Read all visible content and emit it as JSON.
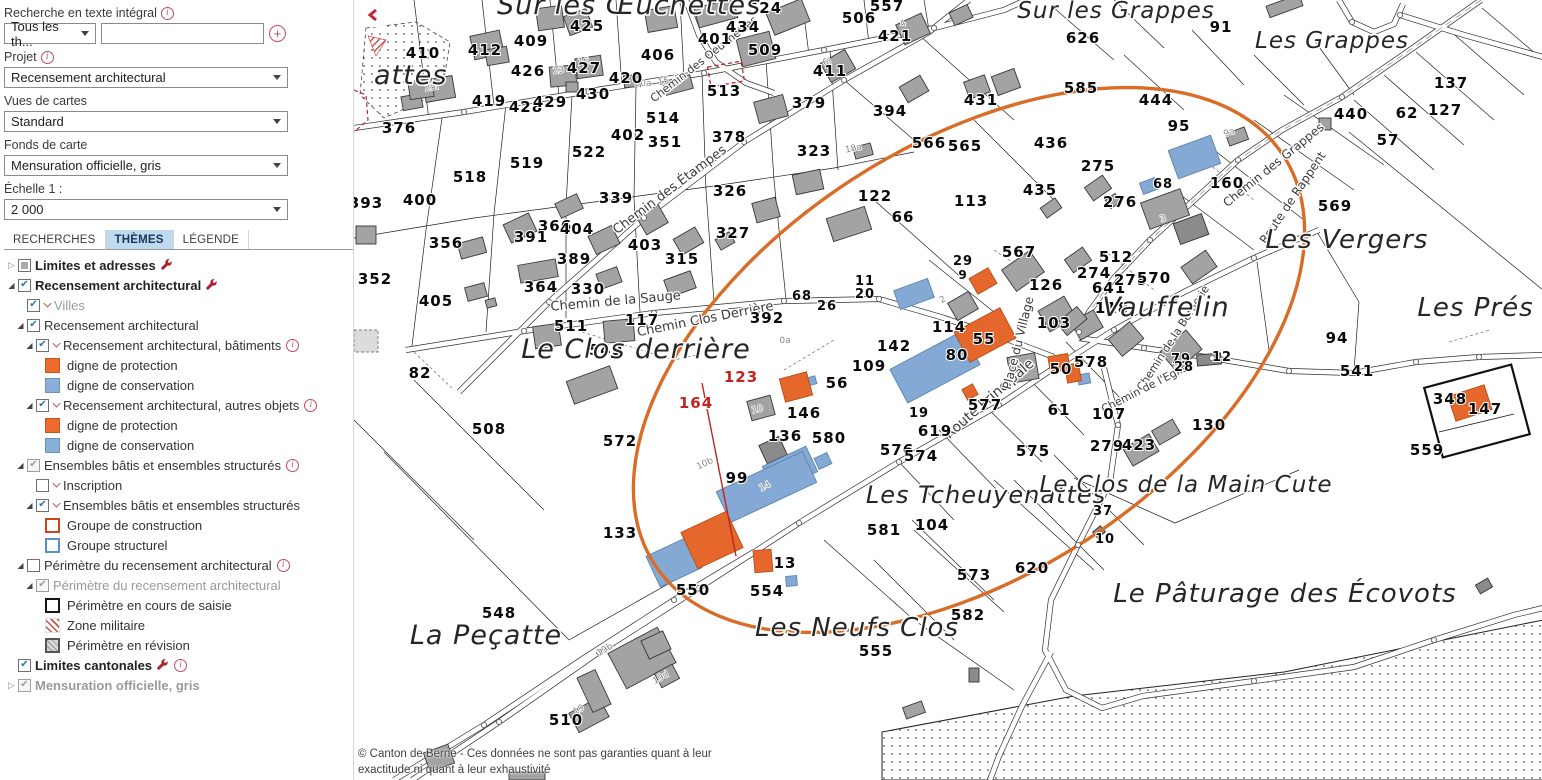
{
  "sidebar": {
    "search": {
      "label": "Recherche en texte intégral",
      "category_value": "Tous les th...",
      "input_value": "",
      "add_label": "+"
    },
    "fields": [
      {
        "label": "Projet",
        "value": "Recensement architectural",
        "info": true
      },
      {
        "label": "Vues de cartes",
        "value": "Standard",
        "info": false
      },
      {
        "label": "Fonds de carte",
        "value": "Mensuration officielle, gris",
        "info": false
      },
      {
        "label": "Échelle 1 :",
        "value": "2 000",
        "info": false
      }
    ],
    "tabs": [
      {
        "label": "RECHERCHES",
        "active": false
      },
      {
        "label": "THÈMES",
        "active": true
      },
      {
        "label": "LÉGENDE",
        "active": false
      }
    ],
    "tree": [
      {
        "indent": 0,
        "exp": "closed",
        "cb": "mixed",
        "label": "Limites et adresses",
        "bold": true,
        "wrench": true
      },
      {
        "indent": 0,
        "exp": "open",
        "cb": "checked",
        "label": "Recensement architectural",
        "bold": true,
        "wrench": true
      },
      {
        "indent": 1,
        "cb": "checked",
        "caret": true,
        "label": "Villes",
        "dim": true
      },
      {
        "indent": 1,
        "exp": "open",
        "cb": "checked",
        "label": "Recensement architectural"
      },
      {
        "indent": 2,
        "exp": "open",
        "cb": "checked",
        "caret": true,
        "label": "Recensement architectural, bâtiments",
        "info": true
      },
      {
        "indent": 3,
        "swatch": "orange",
        "label": "digne de protection"
      },
      {
        "indent": 3,
        "swatch": "blue",
        "label": "digne de conservation"
      },
      {
        "indent": 2,
        "exp": "open",
        "cb": "checked",
        "caret": true,
        "label": "Recensement architectural, autres objets",
        "info": true
      },
      {
        "indent": 3,
        "swatch": "orange",
        "label": "digne de protection"
      },
      {
        "indent": 3,
        "swatch": "blue",
        "label": "digne de conservation"
      },
      {
        "indent": 1,
        "exp": "open",
        "cb": "checked-dim",
        "label": "Ensembles bâtis et ensembles structurés",
        "info": true
      },
      {
        "indent": 2,
        "cb": "unchecked",
        "caret": true,
        "label": "Inscription"
      },
      {
        "indent": 2,
        "exp": "open",
        "cb": "checked",
        "caret": true,
        "label": "Ensembles bâtis et ensembles structurés"
      },
      {
        "indent": 3,
        "swatch": "orange-outline",
        "label": "Groupe de construction"
      },
      {
        "indent": 3,
        "swatch": "blue-outline",
        "label": "Groupe structurel"
      },
      {
        "indent": 1,
        "exp": "open",
        "cb": "unchecked",
        "label": "Périmètre du recensement architectural",
        "info": true
      },
      {
        "indent": 2,
        "exp": "open",
        "cb": "checked-dim",
        "label": "Périmètre du recensement architectural",
        "dim": true
      },
      {
        "indent": 3,
        "swatch": "black-outline",
        "label": "Périmètre en cours de saisie"
      },
      {
        "indent": 3,
        "swatch": "red-hatch",
        "label": "Zone militaire"
      },
      {
        "indent": 3,
        "swatch": "gray-hatch",
        "label": "Périmètre en révision"
      },
      {
        "indent": 0,
        "cb": "checked",
        "label": "Limites cantonales",
        "bold": true,
        "wrench": true,
        "info": true
      },
      {
        "indent": 0,
        "exp": "closed",
        "cb": "checked-dim",
        "label": "Mensuration officielle, gris",
        "bold": true,
        "dim": true
      }
    ]
  },
  "map": {
    "collapse_glyph": "❮",
    "copyright_line1": "© Canton de Berne - Ces données ne sont pas garanties quant à leur",
    "copyright_line2": "exactitude ni quant à leur exhaustivité",
    "places": [
      {
        "t": "Sur les Œuchettes",
        "x": 275,
        "y": 14,
        "s": 27
      },
      {
        "t": "Sur les Grappes",
        "x": 762,
        "y": 18,
        "s": 23
      },
      {
        "t": "Les Grappes",
        "x": 978,
        "y": 48,
        "s": 23
      },
      {
        "t": "Les Vergers",
        "x": 993,
        "y": 248,
        "s": 26
      },
      {
        "t": "Vauffelin",
        "x": 812,
        "y": 316,
        "s": 27
      },
      {
        "t": "Les Prés Dieu",
        "x": 1158,
        "y": 316,
        "s": 26
      },
      {
        "t": "Le Clos derrière",
        "x": 282,
        "y": 358,
        "s": 27
      },
      {
        "t": "Les Tcheuyenattes",
        "x": 632,
        "y": 503,
        "s": 24
      },
      {
        "t": "Le Clos de la Main Cute",
        "x": 832,
        "y": 492,
        "s": 23
      },
      {
        "t": "Les Neufs Clos",
        "x": 503,
        "y": 636,
        "s": 26
      },
      {
        "t": "La Peçatte",
        "x": 132,
        "y": 644,
        "s": 27
      },
      {
        "t": "Le Pâturage des Écovots",
        "x": 931,
        "y": 602,
        "s": 26
      },
      {
        "t": "attes",
        "x": 20,
        "y": 84,
        "s": 27
      }
    ],
    "streets": [
      {
        "t": "Chemin des Oeuchettes",
        "x": 352,
        "y": 62,
        "r": -38,
        "s": 11
      },
      {
        "t": "Chemin des Étampes",
        "x": 318,
        "y": 193,
        "r": -37,
        "s": 13
      },
      {
        "t": "Chemin de la Sauge",
        "x": 262,
        "y": 305,
        "r": -5,
        "s": 13
      },
      {
        "t": "Chemin Clos Derrière",
        "x": 352,
        "y": 323,
        "r": -11,
        "s": 13
      },
      {
        "t": "Route Principale",
        "x": 638,
        "y": 402,
        "r": -41,
        "s": 14
      },
      {
        "t": "Place du Village",
        "x": 668,
        "y": 344,
        "r": -76,
        "s": 12
      },
      {
        "t": "Chemin des Grappes",
        "x": 922,
        "y": 168,
        "r": -39,
        "s": 12
      },
      {
        "t": "Route de Rappent",
        "x": 942,
        "y": 200,
        "r": -56,
        "s": 12
      },
      {
        "t": "Chemin de la Bergerie",
        "x": 822,
        "y": 340,
        "r": -57,
        "s": 11
      },
      {
        "t": "Chemin de l'Eglise",
        "x": 795,
        "y": 390,
        "r": -27,
        "s": 11
      }
    ],
    "parcels": [
      {
        "n": "410",
        "x": 69,
        "y": 58
      },
      {
        "n": "412",
        "x": 131,
        "y": 55
      },
      {
        "n": "409",
        "x": 177,
        "y": 46
      },
      {
        "n": "425",
        "x": 233,
        "y": 31
      },
      {
        "n": "406",
        "x": 304,
        "y": 60
      },
      {
        "n": "401",
        "x": 361,
        "y": 44
      },
      {
        "n": "434",
        "x": 389,
        "y": 32
      },
      {
        "n": "426",
        "x": 174,
        "y": 76
      },
      {
        "n": "427",
        "x": 230,
        "y": 73
      },
      {
        "n": "420",
        "x": 272,
        "y": 83
      },
      {
        "n": "419",
        "x": 135,
        "y": 106
      },
      {
        "n": "428",
        "x": 172,
        "y": 112
      },
      {
        "n": "429",
        "x": 196,
        "y": 107
      },
      {
        "n": "430",
        "x": 239,
        "y": 99
      },
      {
        "n": "513",
        "x": 370,
        "y": 96
      },
      {
        "n": "376",
        "x": 45,
        "y": 133
      },
      {
        "n": "514",
        "x": 309,
        "y": 123
      },
      {
        "n": "402",
        "x": 274,
        "y": 140
      },
      {
        "n": "351",
        "x": 311,
        "y": 147
      },
      {
        "n": "378",
        "x": 375,
        "y": 142
      },
      {
        "n": "522",
        "x": 235,
        "y": 157
      },
      {
        "n": "519",
        "x": 173,
        "y": 168
      },
      {
        "n": "518",
        "x": 116,
        "y": 182
      },
      {
        "n": "400",
        "x": 66,
        "y": 205
      },
      {
        "n": "393",
        "x": 12,
        "y": 208
      },
      {
        "n": "339",
        "x": 262,
        "y": 203
      },
      {
        "n": "326",
        "x": 376,
        "y": 196
      },
      {
        "n": "366",
        "x": 201,
        "y": 231
      },
      {
        "n": "404",
        "x": 223,
        "y": 234
      },
      {
        "n": "391",
        "x": 177,
        "y": 242
      },
      {
        "n": "356",
        "x": 92,
        "y": 248
      },
      {
        "n": "327",
        "x": 379,
        "y": 238
      },
      {
        "n": "403",
        "x": 291,
        "y": 250
      },
      {
        "n": "389",
        "x": 220,
        "y": 264
      },
      {
        "n": "315",
        "x": 328,
        "y": 264
      },
      {
        "n": "352",
        "x": 21,
        "y": 284
      },
      {
        "n": "405",
        "x": 82,
        "y": 306
      },
      {
        "n": "364",
        "x": 187,
        "y": 292
      },
      {
        "n": "330",
        "x": 234,
        "y": 294
      },
      {
        "n": "117",
        "x": 288,
        "y": 325
      },
      {
        "n": "511",
        "x": 217,
        "y": 331
      },
      {
        "n": "549",
        "x": 252,
        "y": 355
      },
      {
        "n": "82",
        "x": 66,
        "y": 378
      },
      {
        "n": "508",
        "x": 135,
        "y": 434
      },
      {
        "n": "572",
        "x": 266,
        "y": 446
      },
      {
        "n": "392",
        "x": 413,
        "y": 323
      },
      {
        "n": "68",
        "x": 448,
        "y": 300,
        "s": 13
      },
      {
        "n": "26",
        "x": 473,
        "y": 310,
        "s": 13
      },
      {
        "n": "11",
        "x": 511,
        "y": 285,
        "s": 13
      },
      {
        "n": "20",
        "x": 511,
        "y": 298,
        "s": 13
      },
      {
        "n": "109",
        "x": 515,
        "y": 371
      },
      {
        "n": "56",
        "x": 483,
        "y": 388
      },
      {
        "n": "146",
        "x": 450,
        "y": 418
      },
      {
        "n": "29",
        "x": 609,
        "y": 265,
        "s": 13
      },
      {
        "n": "9",
        "x": 609,
        "y": 279,
        "s": 12
      },
      {
        "n": "567",
        "x": 665,
        "y": 257
      },
      {
        "n": "512",
        "x": 762,
        "y": 262
      },
      {
        "n": "274",
        "x": 740,
        "y": 278
      },
      {
        "n": "126",
        "x": 692,
        "y": 290
      },
      {
        "n": "641",
        "x": 755,
        "y": 293
      },
      {
        "n": "279",
        "x": 777,
        "y": 285
      },
      {
        "n": "570",
        "x": 800,
        "y": 283
      },
      {
        "n": "118",
        "x": 758,
        "y": 313
      },
      {
        "n": "103",
        "x": 700,
        "y": 328
      },
      {
        "n": "114",
        "x": 595,
        "y": 332
      },
      {
        "n": "142",
        "x": 540,
        "y": 351
      },
      {
        "n": "55",
        "x": 630,
        "y": 344
      },
      {
        "n": "80",
        "x": 603,
        "y": 360
      },
      {
        "n": "50",
        "x": 707,
        "y": 374
      },
      {
        "n": "578",
        "x": 737,
        "y": 367
      },
      {
        "n": "19",
        "x": 565,
        "y": 417,
        "s": 13
      },
      {
        "n": "577",
        "x": 631,
        "y": 410
      },
      {
        "n": "619",
        "x": 581,
        "y": 436
      },
      {
        "n": "61",
        "x": 705,
        "y": 415
      },
      {
        "n": "107",
        "x": 755,
        "y": 419
      },
      {
        "n": "576",
        "x": 543,
        "y": 455
      },
      {
        "n": "574",
        "x": 567,
        "y": 461
      },
      {
        "n": "575",
        "x": 679,
        "y": 456
      },
      {
        "n": "279",
        "x": 753,
        "y": 451
      },
      {
        "n": "423",
        "x": 785,
        "y": 450
      },
      {
        "n": "79",
        "x": 827,
        "y": 363,
        "s": 13
      },
      {
        "n": "12",
        "x": 868,
        "y": 361,
        "s": 13
      },
      {
        "n": "28",
        "x": 830,
        "y": 371,
        "s": 13
      },
      {
        "n": "94",
        "x": 983,
        "y": 343
      },
      {
        "n": "541",
        "x": 1003,
        "y": 376
      },
      {
        "n": "130",
        "x": 855,
        "y": 430
      },
      {
        "n": "147",
        "x": 1131,
        "y": 414
      },
      {
        "n": "559",
        "x": 1073,
        "y": 455
      },
      {
        "n": "348",
        "x": 1096,
        "y": 404
      },
      {
        "n": "37",
        "x": 749,
        "y": 515,
        "s": 13
      },
      {
        "n": "10",
        "x": 751,
        "y": 543,
        "s": 13
      },
      {
        "n": "620",
        "x": 678,
        "y": 573
      },
      {
        "n": "569",
        "x": 981,
        "y": 211
      },
      {
        "n": "160",
        "x": 873,
        "y": 188
      },
      {
        "n": "440",
        "x": 997,
        "y": 119
      },
      {
        "n": "62",
        "x": 1053,
        "y": 118
      },
      {
        "n": "57",
        "x": 1034,
        "y": 145
      },
      {
        "n": "137",
        "x": 1097,
        "y": 88
      },
      {
        "n": "127",
        "x": 1091,
        "y": 115
      },
      {
        "n": "444",
        "x": 802,
        "y": 105
      },
      {
        "n": "95",
        "x": 825,
        "y": 131
      },
      {
        "n": "91",
        "x": 867,
        "y": 32
      },
      {
        "n": "626",
        "x": 729,
        "y": 43
      },
      {
        "n": "585",
        "x": 727,
        "y": 93
      },
      {
        "n": "436",
        "x": 697,
        "y": 148
      },
      {
        "n": "275",
        "x": 744,
        "y": 171
      },
      {
        "n": "276",
        "x": 766,
        "y": 207
      },
      {
        "n": "68",
        "x": 809,
        "y": 188,
        "s": 13
      },
      {
        "n": "435",
        "x": 686,
        "y": 195
      },
      {
        "n": "113",
        "x": 617,
        "y": 206
      },
      {
        "n": "566",
        "x": 575,
        "y": 148
      },
      {
        "n": "565",
        "x": 611,
        "y": 151
      },
      {
        "n": "122",
        "x": 521,
        "y": 201
      },
      {
        "n": "66",
        "x": 549,
        "y": 222
      },
      {
        "n": "323",
        "x": 460,
        "y": 156
      },
      {
        "n": "379",
        "x": 455,
        "y": 108
      },
      {
        "n": "394",
        "x": 536,
        "y": 116
      },
      {
        "n": "431",
        "x": 627,
        "y": 105
      },
      {
        "n": "421",
        "x": 541,
        "y": 41
      },
      {
        "n": "411",
        "x": 476,
        "y": 76
      },
      {
        "n": "509",
        "x": 411,
        "y": 55
      },
      {
        "n": "506",
        "x": 505,
        "y": 23
      },
      {
        "n": "557",
        "x": 533,
        "y": 11
      },
      {
        "n": "524",
        "x": 411,
        "y": 13
      },
      {
        "n": "136",
        "x": 431,
        "y": 441
      },
      {
        "n": "580",
        "x": 475,
        "y": 443
      },
      {
        "n": "99",
        "x": 383,
        "y": 483
      },
      {
        "n": "133",
        "x": 266,
        "y": 538
      },
      {
        "n": "581",
        "x": 530,
        "y": 535
      },
      {
        "n": "104",
        "x": 578,
        "y": 530
      },
      {
        "n": "13",
        "x": 431,
        "y": 568
      },
      {
        "n": "554",
        "x": 413,
        "y": 596
      },
      {
        "n": "550",
        "x": 339,
        "y": 595
      },
      {
        "n": "573",
        "x": 620,
        "y": 580
      },
      {
        "n": "582",
        "x": 614,
        "y": 620
      },
      {
        "n": "555",
        "x": 522,
        "y": 656
      },
      {
        "n": "548",
        "x": 145,
        "y": 618
      },
      {
        "n": "510",
        "x": 212,
        "y": 725
      }
    ],
    "parcels_red": [
      {
        "n": "123",
        "x": 387,
        "y": 382
      },
      {
        "n": "164",
        "x": 342,
        "y": 408
      }
    ],
    "lots": [
      {
        "t": "16",
        "x": 230,
        "y": 64,
        "r": -8
      },
      {
        "t": "23",
        "x": 205,
        "y": 73,
        "r": -8
      },
      {
        "t": "25i",
        "x": 78,
        "y": 90,
        "r": -8
      },
      {
        "t": "20a",
        "x": 289,
        "y": 86,
        "r": 0
      },
      {
        "t": "6i",
        "x": 474,
        "y": 64,
        "r": -25
      },
      {
        "t": "4",
        "x": 550,
        "y": 26,
        "r": -25
      },
      {
        "t": "15",
        "x": 310,
        "y": 84,
        "r": -12
      },
      {
        "t": "18a",
        "x": 500,
        "y": 151,
        "r": -12
      },
      {
        "t": "9a",
        "x": 876,
        "y": 135,
        "r": -18
      },
      {
        "t": "3",
        "x": 810,
        "y": 221,
        "r": -20
      },
      {
        "t": "19b",
        "x": 252,
        "y": 652,
        "r": -30
      },
      {
        "t": "19d",
        "x": 308,
        "y": 680,
        "r": -30
      },
      {
        "t": "19",
        "x": 226,
        "y": 712,
        "r": -30
      },
      {
        "t": "14",
        "x": 412,
        "y": 489,
        "r": -25
      },
      {
        "t": "10b",
        "x": 352,
        "y": 466,
        "r": -25
      },
      {
        "t": "2",
        "x": 590,
        "y": 302,
        "r": -30
      },
      {
        "t": "10",
        "x": 404,
        "y": 412,
        "r": -12
      },
      {
        "t": "0a",
        "x": 431,
        "y": 343,
        "r": 0
      }
    ]
  },
  "colors": {
    "protection_orange": "#ed6b2f",
    "conservation_blue": "#8ab0d9",
    "highlight_ellipse": "#d96d28",
    "red_annotation": "#c22222",
    "tab_active_bg": "#bfd9ef",
    "accent_crimson": "#c2495f"
  }
}
